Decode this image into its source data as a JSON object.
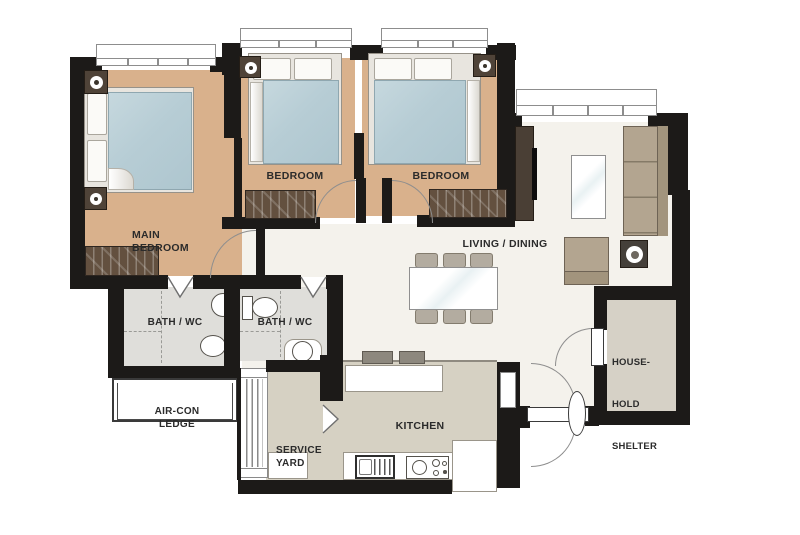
{
  "title": "3-bedroom apartment floor plan",
  "colors": {
    "wall": "#1c1a18",
    "bedroom-floor": "#d9b18c",
    "living-floor": "#f4f2ec",
    "kitchen-floor": "#d6d1c3",
    "bath-floor": "#dfdeda",
    "shelter-floor": "#d6d1c6",
    "mattress": "#b7cdd5",
    "wardrobe": "#63503f",
    "sofa": "#b3a590",
    "chair": "#b3aca0",
    "console": "#4a3f35",
    "accent-dark": "#4f4338",
    "arc": "#8e8e8e",
    "label": "#2b2b2b"
  },
  "rooms": {
    "main_bedroom": {
      "line1": "MAIN",
      "line2": "BEDROOM"
    },
    "bedroom2": {
      "label": "BEDROOM"
    },
    "bedroom3": {
      "label": "BEDROOM"
    },
    "living_dining": {
      "label": "LIVING / DINING"
    },
    "bath1": {
      "label": "BATH / WC"
    },
    "bath2": {
      "label": "BATH / WC"
    },
    "aircon_ledge": {
      "line1": "AIR-CON",
      "line2": "LEDGE"
    },
    "service_yard": {
      "line1": "SERVICE",
      "line2": "YARD"
    },
    "kitchen": {
      "label": "KITCHEN"
    },
    "household_shelter": {
      "line1": "HOUSE-",
      "line2": "HOLD",
      "line3": "SHELTER"
    }
  }
}
